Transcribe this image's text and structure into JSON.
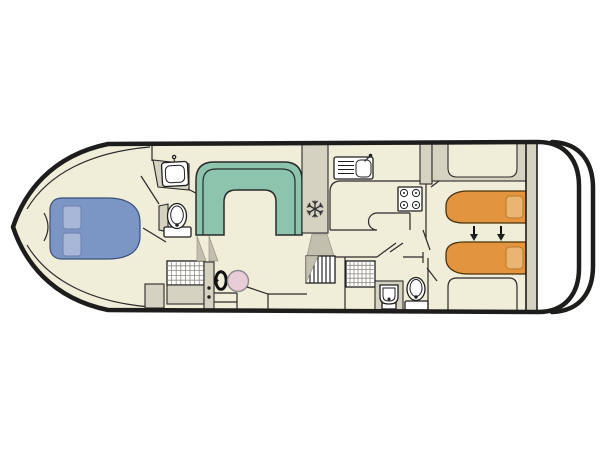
{
  "diagram": {
    "type": "boat-floor-plan",
    "name": "river-cruiser-deck-plan",
    "orientation": "bow-left-stern-right"
  },
  "colors": {
    "background": "#ffffff",
    "hull_outline": "#1d1d1b",
    "floor": "#f0edd8",
    "wall": "#d6d2c2",
    "stair_shade": "#c3bfae",
    "dinette_green": "#8cc4ae",
    "bed_blue": "#7b96c4",
    "pillow_blue": "#a8b7d7",
    "bed_orange": "#e2943e",
    "pillow_orange": "#eab473",
    "helm_seat_pink": "#e8cdd9",
    "fixture_white": "#ffffff",
    "grid_line": "#8f8a7d"
  },
  "rooms": {
    "bow_cabin": "bow-cabin-double-bed",
    "bow_bathroom": "forward-bathroom",
    "saloon": "saloon-with-dinette",
    "galley": "galley-kitchen",
    "helm": "helm-station",
    "aft_bathroom": "aft-bathroom",
    "aft_cabin": "aft-cabin-twin-beds",
    "stern": "swim-platform"
  },
  "fixtures": [
    "double-bed",
    "bed-pillow",
    "washbasin",
    "toilet",
    "shower-tray",
    "u-shaped-dinette",
    "fridge-snowflake",
    "companionway-steps",
    "kitchen-sink-with-drainer",
    "stove-hob-4-burners",
    "steering-wheel",
    "helm-seat",
    "single-bed",
    "bed-slide-arrows",
    "swim-platform"
  ]
}
